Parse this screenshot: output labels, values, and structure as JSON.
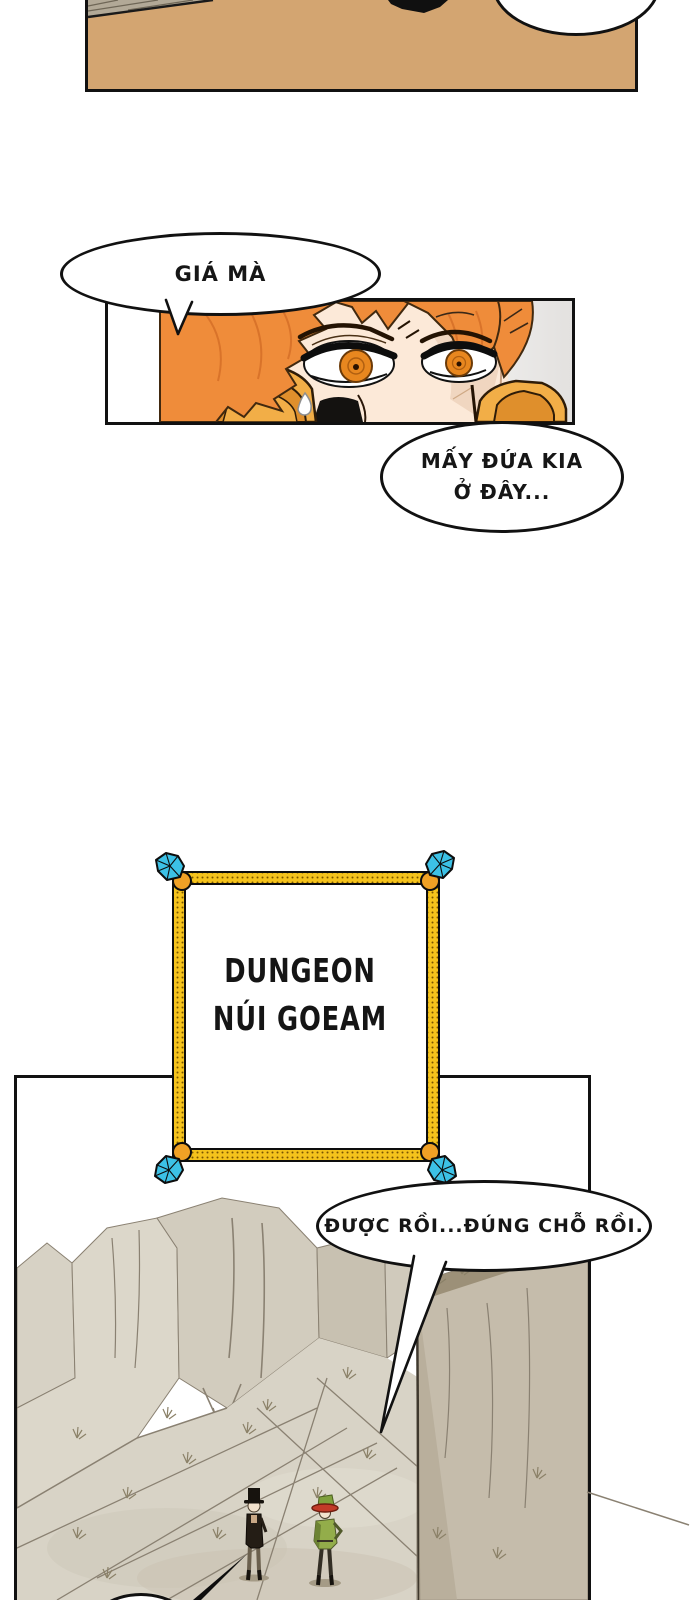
{
  "page": {
    "kind": "webtoon-comic-page",
    "background": "#ffffff"
  },
  "colors": {
    "ink": "#111111",
    "top-panel-fill": "#d3a571",
    "roof-gray": "#b2a997",
    "hair-orange": "#ef8c3a",
    "hair-outline": "#41290f",
    "skin": "#fce9d8",
    "skin-shade": "#f0d6c0",
    "iris-orange": "#e8871f",
    "armor-gold": "#f2ae47",
    "armor-gold-dark": "#df8f2c",
    "sign-gold": "#f5c31c",
    "sign-cap-orange": "#f0a125",
    "gem-cyan": "#3cc1e6",
    "canyon-light": "#dcd7ca",
    "canyon-mid": "#c8c1b1",
    "canyon-ground": "#d8d3c6",
    "canyon-rim": "#9c9078",
    "canyon-line": "#8a8172",
    "jacket-green": "#93ad4a",
    "hat-red": "#c23a28"
  },
  "speech_bubbles": {
    "gia_ma": {
      "text": "GIÁ MÀ"
    },
    "may_dua": {
      "line1": "MẤY ĐỨA KIA",
      "line2": "Ở ĐÂY..."
    },
    "duoc_roi": {
      "text": "ĐƯỢC RỒI...ĐÚNG CHỖ RỒI."
    }
  },
  "sign": {
    "line1": "DUNGEON",
    "line2": "NÚI GOEAM"
  }
}
